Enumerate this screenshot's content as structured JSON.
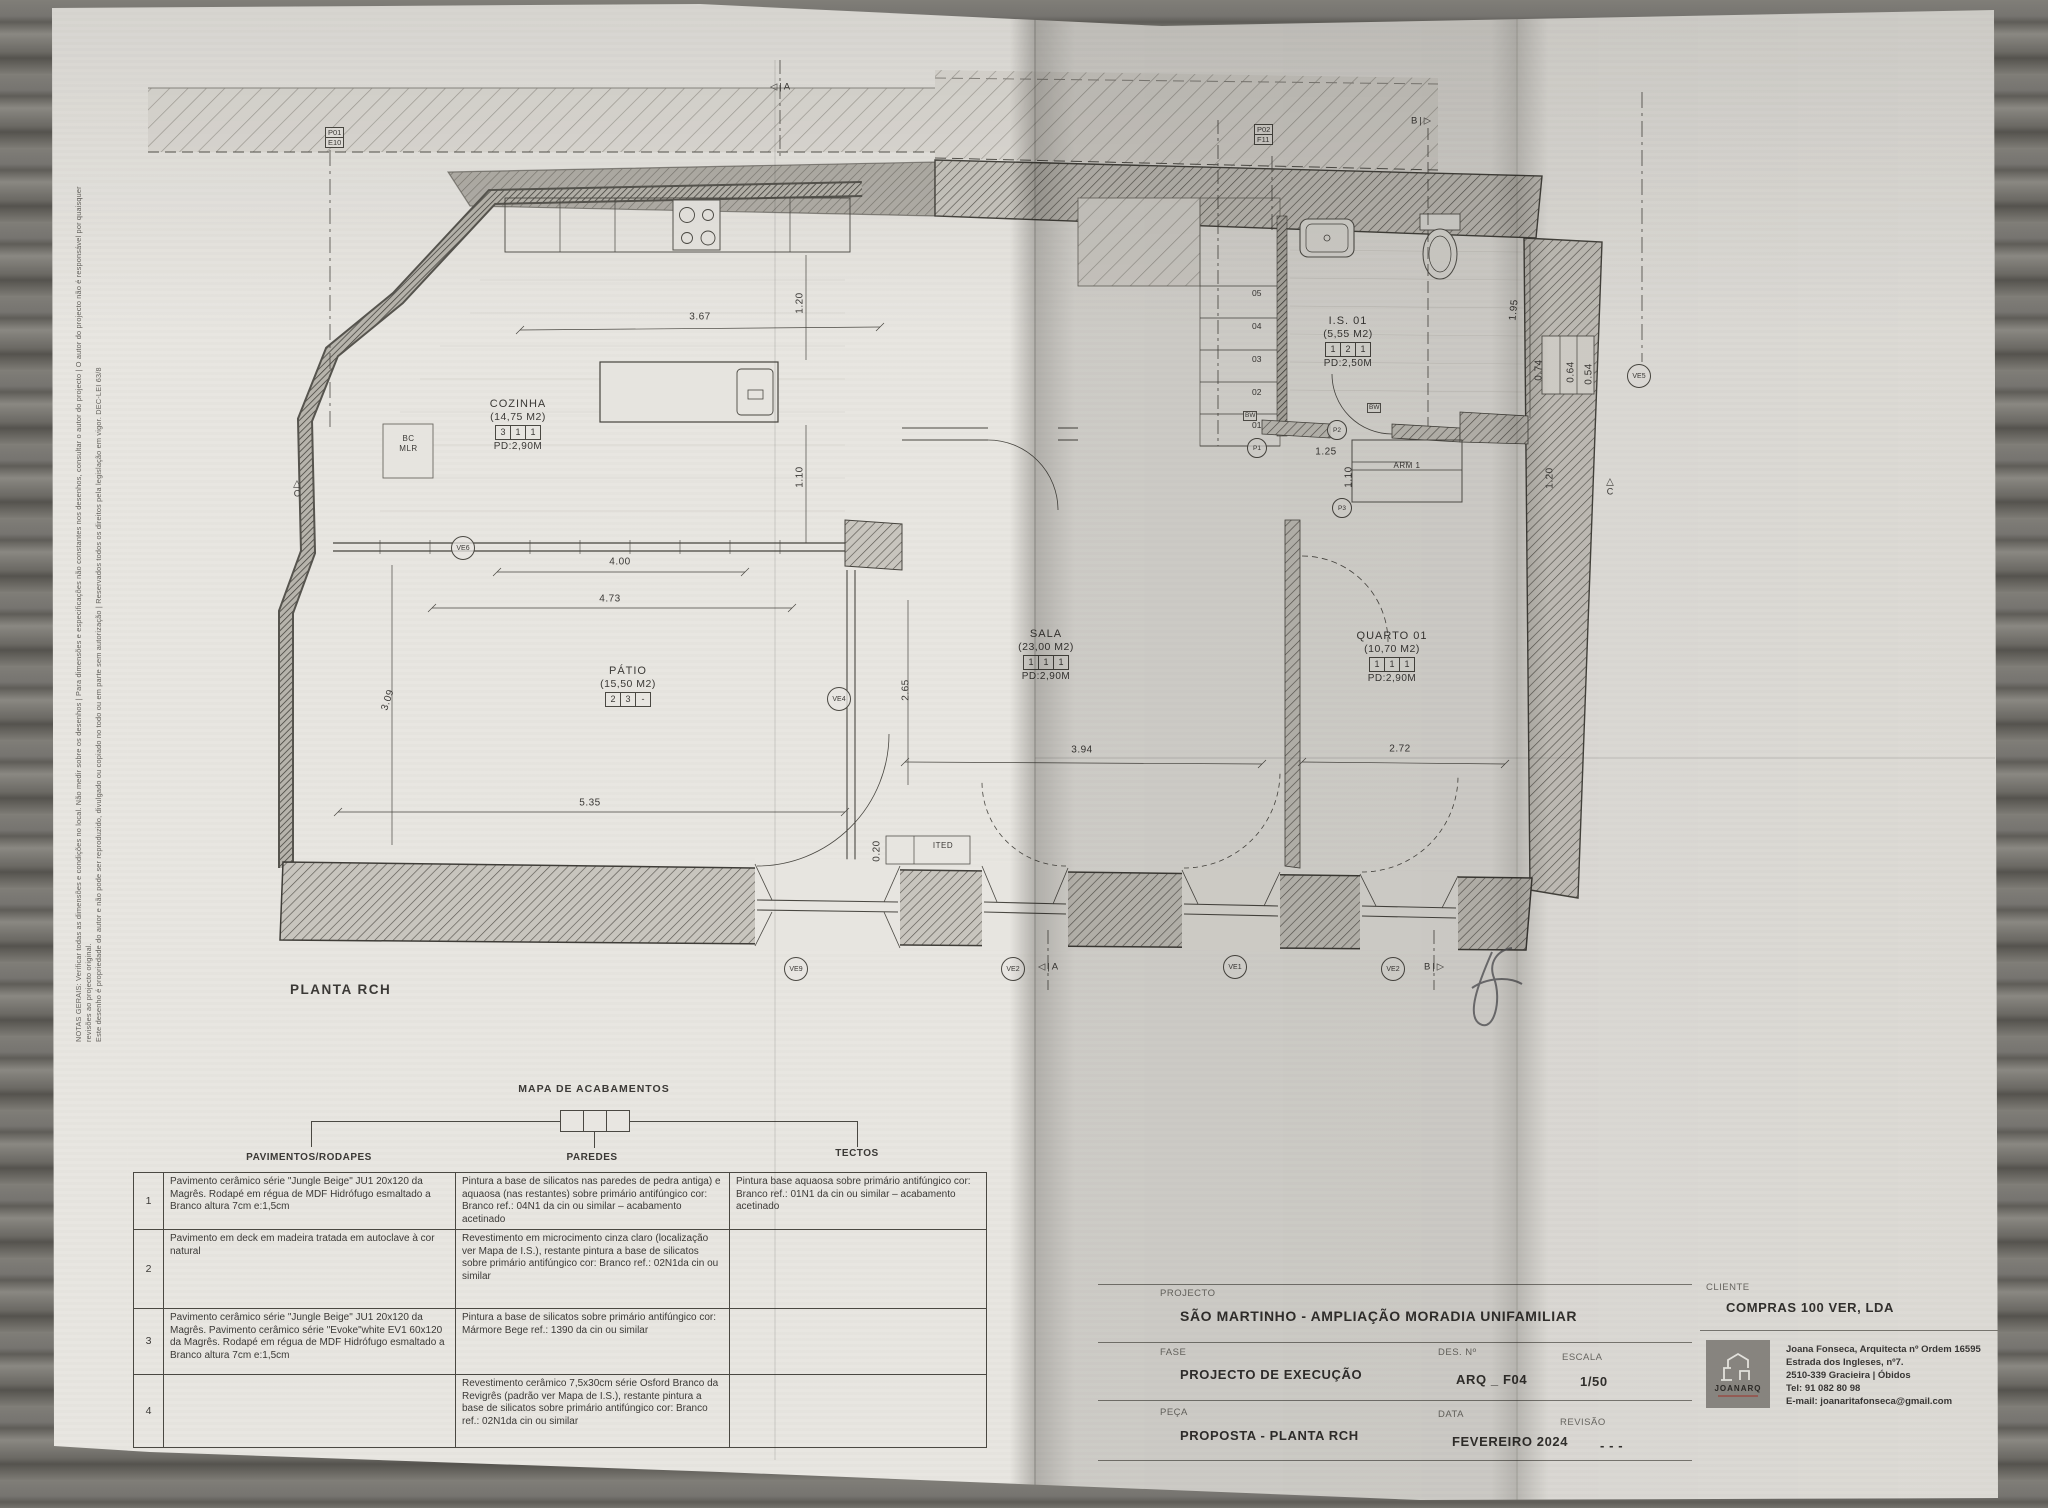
{
  "colors": {
    "paper": "#e8e6e1",
    "ink": "#3b3936",
    "wood": "#6f6d68",
    "logo_bg": "#8f8c86",
    "logo_accent": "#a0524a"
  },
  "notes": {
    "line1": "NOTAS GERAIS: Verificar todas as dimensões e condições no local. Não medir sobre os desenhos | Para dimensões e especificações não constantes nos desenhos, consultar o autor do projecto | O autor do projecto não é responsável por quaisquer revisões ao projecto original.",
    "line2": "Este desenho é propriedade do autor e não pode ser reproduzido, divulgado ou copiado no todo ou em parte sem autorização | Reservados todos os direitos pela legislação em vigor. DEC-LEI 63/8"
  },
  "plan": {
    "title": "PLANTA RCH",
    "rooms": [
      {
        "id": "cozinha",
        "name": "COZINHA",
        "area": "(14,75 M2)",
        "codes": [
          "3",
          "1",
          "1"
        ],
        "pd": "PD:2,90M",
        "x": 518,
        "y": 398
      },
      {
        "id": "patio",
        "name": "PÁTIO",
        "area": "(15,50 M2)",
        "codes": [
          "2",
          "3",
          "-"
        ],
        "pd": "",
        "x": 628,
        "y": 665
      },
      {
        "id": "sala",
        "name": "SALA",
        "area": "(23,00 M2)",
        "codes": [
          "1",
          "1",
          "1"
        ],
        "pd": "PD:2,90M",
        "x": 1046,
        "y": 628
      },
      {
        "id": "quarto",
        "name": "QUARTO 01",
        "area": "(10,70 M2)",
        "codes": [
          "1",
          "1",
          "1"
        ],
        "pd": "PD:2,90M",
        "x": 1392,
        "y": 630
      },
      {
        "id": "is01",
        "name": "I.S. 01",
        "area": "(5,55 M2)",
        "codes": [
          "1",
          "2",
          "1"
        ],
        "pd": "PD:2,50M",
        "x": 1348,
        "y": 315
      }
    ],
    "dims": [
      {
        "v": "3.67",
        "x": 700,
        "y": 317,
        "rot": 0
      },
      {
        "v": "1.20",
        "x": 800,
        "y": 303,
        "rot": -90
      },
      {
        "v": "1.10",
        "x": 800,
        "y": 477,
        "rot": -90
      },
      {
        "v": "4.00",
        "x": 620,
        "y": 562,
        "rot": 0
      },
      {
        "v": "4.73",
        "x": 610,
        "y": 599,
        "rot": 0
      },
      {
        "v": "5.35",
        "x": 590,
        "y": 803,
        "rot": 0
      },
      {
        "v": "3.09",
        "x": 388,
        "y": 700,
        "rot": -72
      },
      {
        "v": "2.65",
        "x": 906,
        "y": 690,
        "rot": -90
      },
      {
        "v": "3.94",
        "x": 1082,
        "y": 750,
        "rot": 0
      },
      {
        "v": "2.72",
        "x": 1400,
        "y": 749,
        "rot": 0
      },
      {
        "v": "1.25",
        "x": 1326,
        "y": 452,
        "rot": 0
      },
      {
        "v": "1.10",
        "x": 1349,
        "y": 477,
        "rot": -90
      },
      {
        "v": "1.20",
        "x": 1550,
        "y": 478,
        "rot": -90
      },
      {
        "v": "1.95",
        "x": 1514,
        "y": 310,
        "rot": -84
      },
      {
        "v": "0.74",
        "x": 1539,
        "y": 370,
        "rot": -90
      },
      {
        "v": "0.64",
        "x": 1571,
        "y": 372,
        "rot": -90
      },
      {
        "v": "0.54",
        "x": 1589,
        "y": 374,
        "rot": -90
      },
      {
        "v": "0.20",
        "x": 877,
        "y": 851,
        "rot": -90
      }
    ],
    "markers": [
      {
        "label": "VE6",
        "x": 462,
        "y": 547,
        "r": 11
      },
      {
        "label": "VE4",
        "x": 838,
        "y": 698,
        "r": 11
      },
      {
        "label": "VE5",
        "x": 1638,
        "y": 375,
        "r": 11
      },
      {
        "label": "VE9",
        "x": 795,
        "y": 968,
        "r": 11
      },
      {
        "label": "VE2",
        "x": 1012,
        "y": 968,
        "r": 11
      },
      {
        "label": "VE1",
        "x": 1234,
        "y": 966,
        "r": 11
      },
      {
        "label": "VE2",
        "x": 1392,
        "y": 968,
        "r": 11
      },
      {
        "label": "P1",
        "x": 1256,
        "y": 447,
        "r": 9
      },
      {
        "label": "P2",
        "x": 1336,
        "y": 429,
        "r": 9
      },
      {
        "label": "P3",
        "x": 1341,
        "y": 507,
        "r": 9
      }
    ],
    "ref_boxes": [
      {
        "lines": [
          "P01",
          "E10"
        ],
        "x": 337,
        "y": 139
      },
      {
        "lines": [
          "P02",
          "F11"
        ],
        "x": 1266,
        "y": 136
      }
    ],
    "section_markers": [
      {
        "label": "A",
        "x": 780,
        "y": 87,
        "side": "left"
      },
      {
        "label": "B",
        "x": 1421,
        "y": 121,
        "side": "right"
      },
      {
        "label": "A",
        "x": 1048,
        "y": 967,
        "side": "left"
      },
      {
        "label": "B",
        "x": 1434,
        "y": 967,
        "side": "right"
      },
      {
        "label": "C",
        "x": 297,
        "y": 489,
        "tri": "up"
      },
      {
        "label": "C",
        "x": 1610,
        "y": 487,
        "tri": "up"
      }
    ],
    "stairs": {
      "x": 1252,
      "y0": 288,
      "dy": 33,
      "numbers": [
        "05",
        "04",
        "03",
        "02",
        "01"
      ]
    },
    "bw_text": "BW",
    "bw_labels": [
      {
        "x": 1243,
        "y": 411
      },
      {
        "x": 1367,
        "y": 403
      }
    ],
    "small_labels": [
      {
        "id": "bc-mlr",
        "lines": [
          "BC",
          "MLR"
        ],
        "x": 384,
        "y": 434,
        "w": 49
      },
      {
        "id": "arm-1",
        "lines": [
          "ARM 1"
        ],
        "x": 1366,
        "y": 461,
        "w": 82
      },
      {
        "id": "ited",
        "lines": [
          "ITED"
        ],
        "x": 917,
        "y": 841,
        "w": 52
      }
    ]
  },
  "finishes": {
    "title": "MAPA DE ACABAMENTOS",
    "columns": [
      "PAVIMENTOS/RODAPES",
      "PAREDES",
      "TECTOS"
    ],
    "rows": [
      {
        "num": "1",
        "pavimentos": "Pavimento cerâmico série \"Jungle Beige\" JU1 20x120 da Magrês. Rodapé em régua de MDF Hidrófugo esmaltado a Branco altura 7cm e:1,5cm",
        "paredes": "Pintura a base de silicatos nas paredes de pedra antiga) e aquaosa (nas restantes) sobre primário antifúngico cor: Branco ref.: 04N1 da cin ou similar – acabamento acetinado",
        "tectos": "Pintura base aquaosa sobre primário antifúngico cor: Branco ref.: 01N1 da cin ou similar – acabamento acetinado"
      },
      {
        "num": "2",
        "pavimentos": "Pavimento em deck em madeira tratada em autoclave à cor natural",
        "paredes": "Revestimento em microcimento cinza claro (localização ver Mapa de I.S.), restante pintura a base de silicatos sobre primário antifúngico cor: Branco ref.: 02N1da cin ou similar",
        "tectos": ""
      },
      {
        "num": "3",
        "pavimentos": "Pavimento cerâmico série \"Jungle Beige\" JU1 20x120 da Magrês. Pavimento cerâmico série \"Evoke\"white EV1 60x120 da Magrês. Rodapé em régua de MDF Hidrófugo esmaltado a Branco altura 7cm e:1,5cm",
        "paredes": "Pintura a base de silicatos sobre primário antifúngico cor: Mármore Bege ref.: 1390 da cin ou similar",
        "tectos": ""
      },
      {
        "num": "4",
        "pavimentos": "",
        "paredes": "Revestimento cerâmico 7,5x30cm série Osford Branco da Revigrês (padrão ver Mapa de I.S.), restante pintura a base de silicatos sobre primário antifúngico cor: Branco ref.: 02N1da cin ou similar",
        "tectos": ""
      }
    ]
  },
  "title_block": {
    "projecto_label": "PROJECTO",
    "projecto": "SÃO MARTINHO  -  AMPLIAÇÃO  MORADIA UNIFAMILIAR",
    "fase_label": "FASE",
    "fase": "PROJECTO DE EXECUÇÃO",
    "des_label": "DES. Nº",
    "des": "ARQ _ F04",
    "escala_label": "ESCALA",
    "escala": "1/50",
    "peca_label": "PEÇA",
    "peca": "PROPOSTA - PLANTA RCH",
    "data_label": "DATA",
    "data": "FEVEREIRO 2024",
    "revisao_label": "REVISÃO",
    "revisao": "- - -",
    "cliente_label": "CLIENTE",
    "cliente": "COMPRAS 100 VER, LDA"
  },
  "architect": {
    "logo": "JOANARQ",
    "line1": "Joana Fonseca, Arquitecta nº Ordem 16595",
    "line2": "Estrada dos Ingleses, nº7.",
    "line3": "2510-339 Gracieira | Óbidos",
    "line4": "Tel: 91 082 80 98",
    "line5": "E-mail: joanaritafonseca@gmail.com"
  }
}
